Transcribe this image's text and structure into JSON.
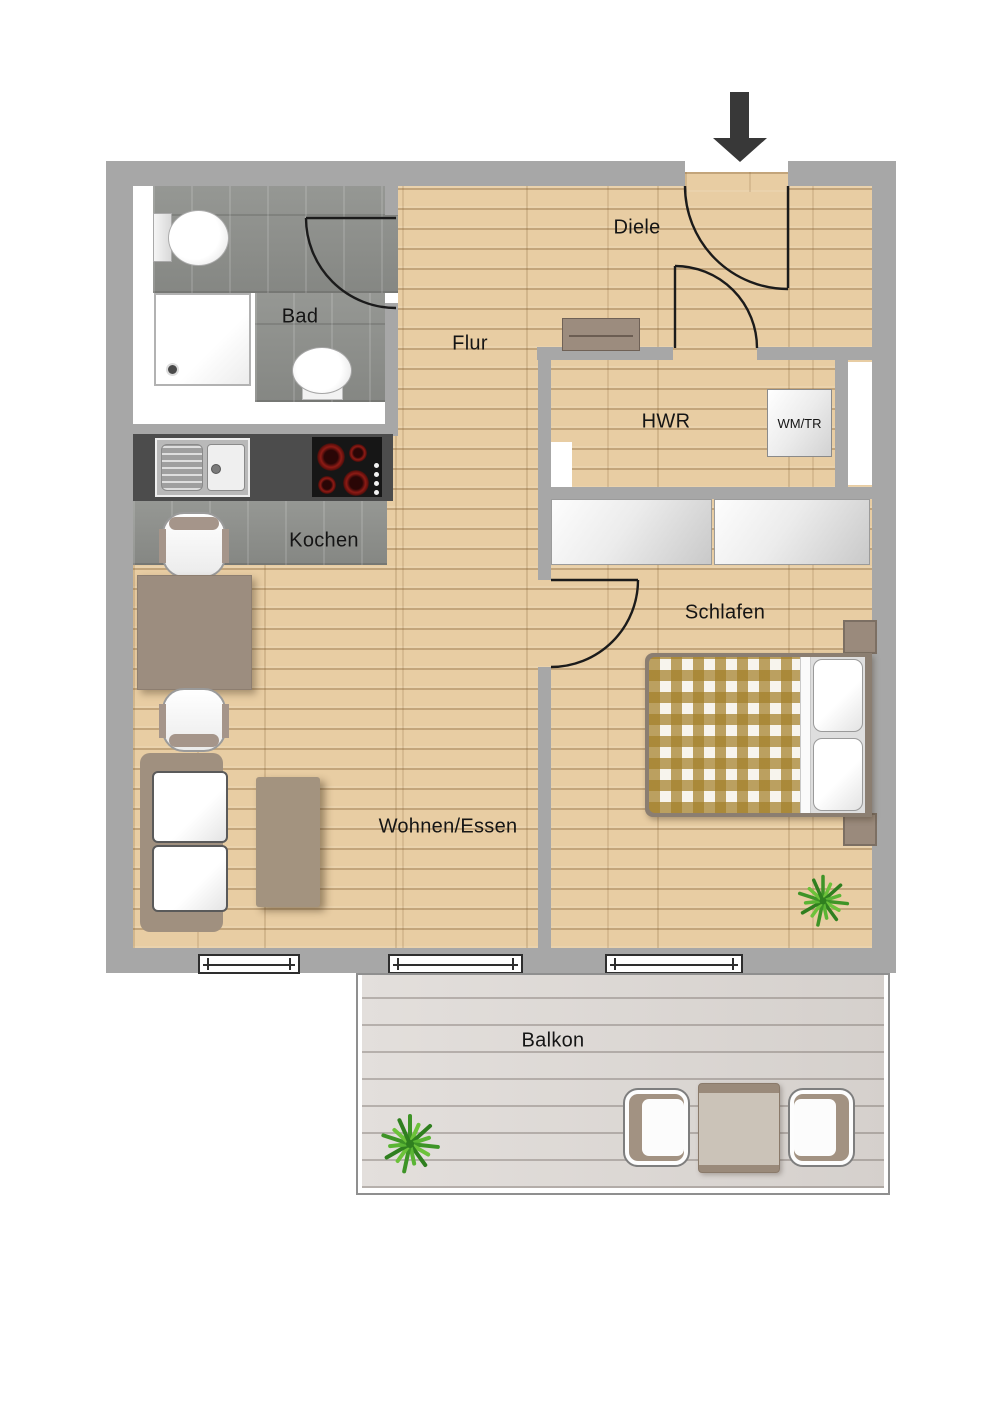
{
  "floorplan": {
    "labels": {
      "bad": "Bad",
      "flur": "Flur",
      "diele": "Diele",
      "hwr": "HWR",
      "wmtr": "WM/TR",
      "kochen": "Kochen",
      "schlafen": "Schlafen",
      "wohnen_essen": "Wohnen/Essen",
      "balkon": "Balkon"
    },
    "colors": {
      "wall": "#a7a7a7",
      "wood_floor": "#e8cda3",
      "bath_tile": "#8f918d",
      "kitchen_counter": "#4c4c4c",
      "furniture_taupe": "#9c8d7f",
      "blanket_check_brown": "#a6822c",
      "balcony_deck": "#dcd7d3",
      "plant_green": "#4da32f",
      "entrance_arrow": "#383838",
      "text": "#151515"
    }
  }
}
